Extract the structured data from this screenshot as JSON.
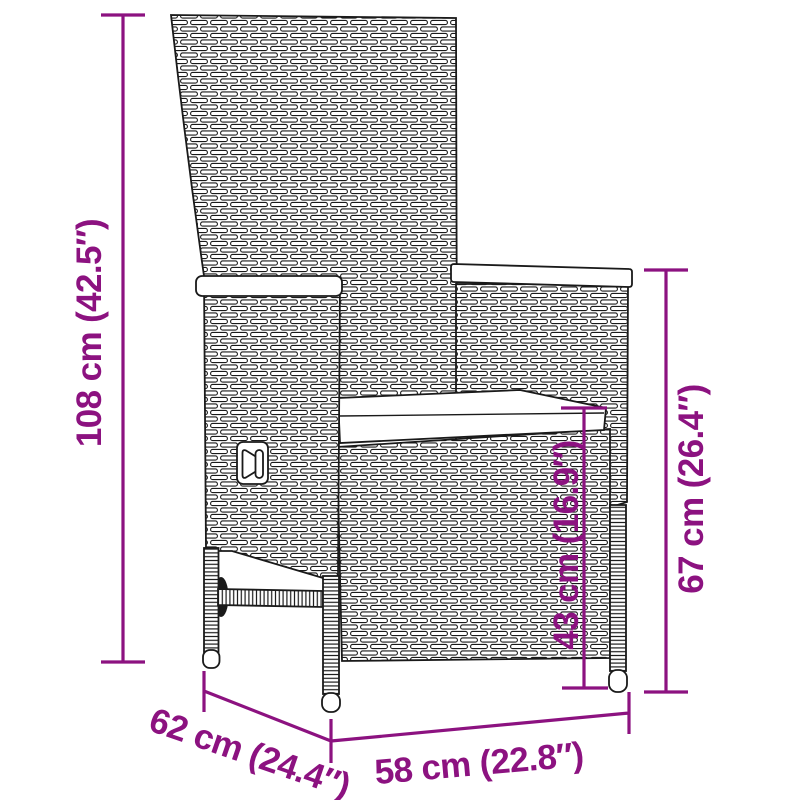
{
  "colors": {
    "dimension_accent": "#8c1280",
    "line_art": "#1a1a1a",
    "background": "#ffffff"
  },
  "dimensions": {
    "total_height": {
      "label": "108 cm (42.5″)",
      "cm": 108,
      "inches": 42.5
    },
    "armrest_height": {
      "label": "67 cm (26.4″)",
      "cm": 67,
      "inches": 26.4
    },
    "seat_height": {
      "label": "43 cm (16.9″)",
      "cm": 43,
      "inches": 16.9
    },
    "seat_depth": {
      "label": "62 cm (24.4″)",
      "cm": 62,
      "inches": 24.4
    },
    "seat_width": {
      "label": "58 cm (22.8″)",
      "cm": 58,
      "inches": 22.8
    }
  }
}
